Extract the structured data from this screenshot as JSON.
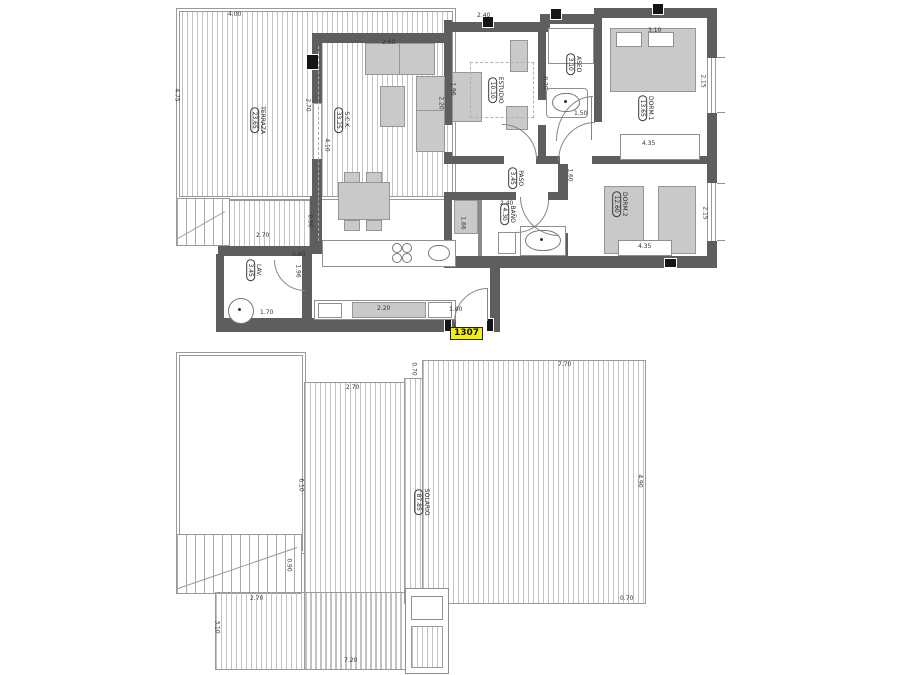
{
  "badge": {
    "label": "1307"
  },
  "upper_plan": {
    "rooms": {
      "terraza": {
        "name": "TERRAZA",
        "area": "23.65"
      },
      "sck": {
        "name": "S.C.K.",
        "area": "33.25"
      },
      "estudio": {
        "name": "ESTUDIO",
        "area": "10.10"
      },
      "aseo": {
        "name": "ASEO",
        "area": "3.10"
      },
      "dorm1": {
        "name": "DORM.1",
        "area": "13.65"
      },
      "paso": {
        "name": "PASO",
        "area": "3.45"
      },
      "bano": {
        "name": "BAÑO",
        "area": "4.30"
      },
      "dorm2": {
        "name": "DORM.2",
        "area": "12.60"
      },
      "lav": {
        "name": "LAV.",
        "area": "3.45"
      }
    },
    "dims": {
      "terraza_width": "4.00",
      "terraza_height": "4.75",
      "terraza_door": "2.70",
      "sck_height": "4.10",
      "sofa": "2.60",
      "estudio_width": "2.40",
      "estudio_depth": "1.96",
      "estudio_side": "2.20",
      "aseo_side": "0.70",
      "aseo_door": "1.50",
      "dorm1_width": "3.10",
      "dorm1_window": "2.15",
      "dorm1_wardrobe": "4.35",
      "paso_height": "1.60",
      "bano_width": "2.40",
      "closet_height": "1.66",
      "dorm2_window": "2.15",
      "dorm2_wardrobe": "4.35",
      "stairs_width": "2.70",
      "stairs_step": "0.90",
      "kitchen_gap": "0.60",
      "lav_height": "1.96",
      "lav_width": "1.70",
      "counter": "2.20",
      "entry_door": "1.40"
    }
  },
  "lower_plan": {
    "rooms": {
      "solario": {
        "name": "SOLARIO",
        "area": "87.85"
      }
    },
    "dims": {
      "top_left": "2.70",
      "notch": "0.70",
      "top_right": "7.70",
      "left_height": "6.10",
      "right_height": "4.90",
      "bottom_right": "0.70",
      "terrace_width": "2.70",
      "terrace_height": "3.10",
      "bottom_width": "7.20",
      "stair": "0.90"
    }
  },
  "colors": {
    "wall": "#5e5e5e",
    "furniture": "#c9c9c9",
    "hatch_line": "#c2c2c2",
    "badge_bg": "#f2ee14",
    "line": "#8a8a8a"
  }
}
